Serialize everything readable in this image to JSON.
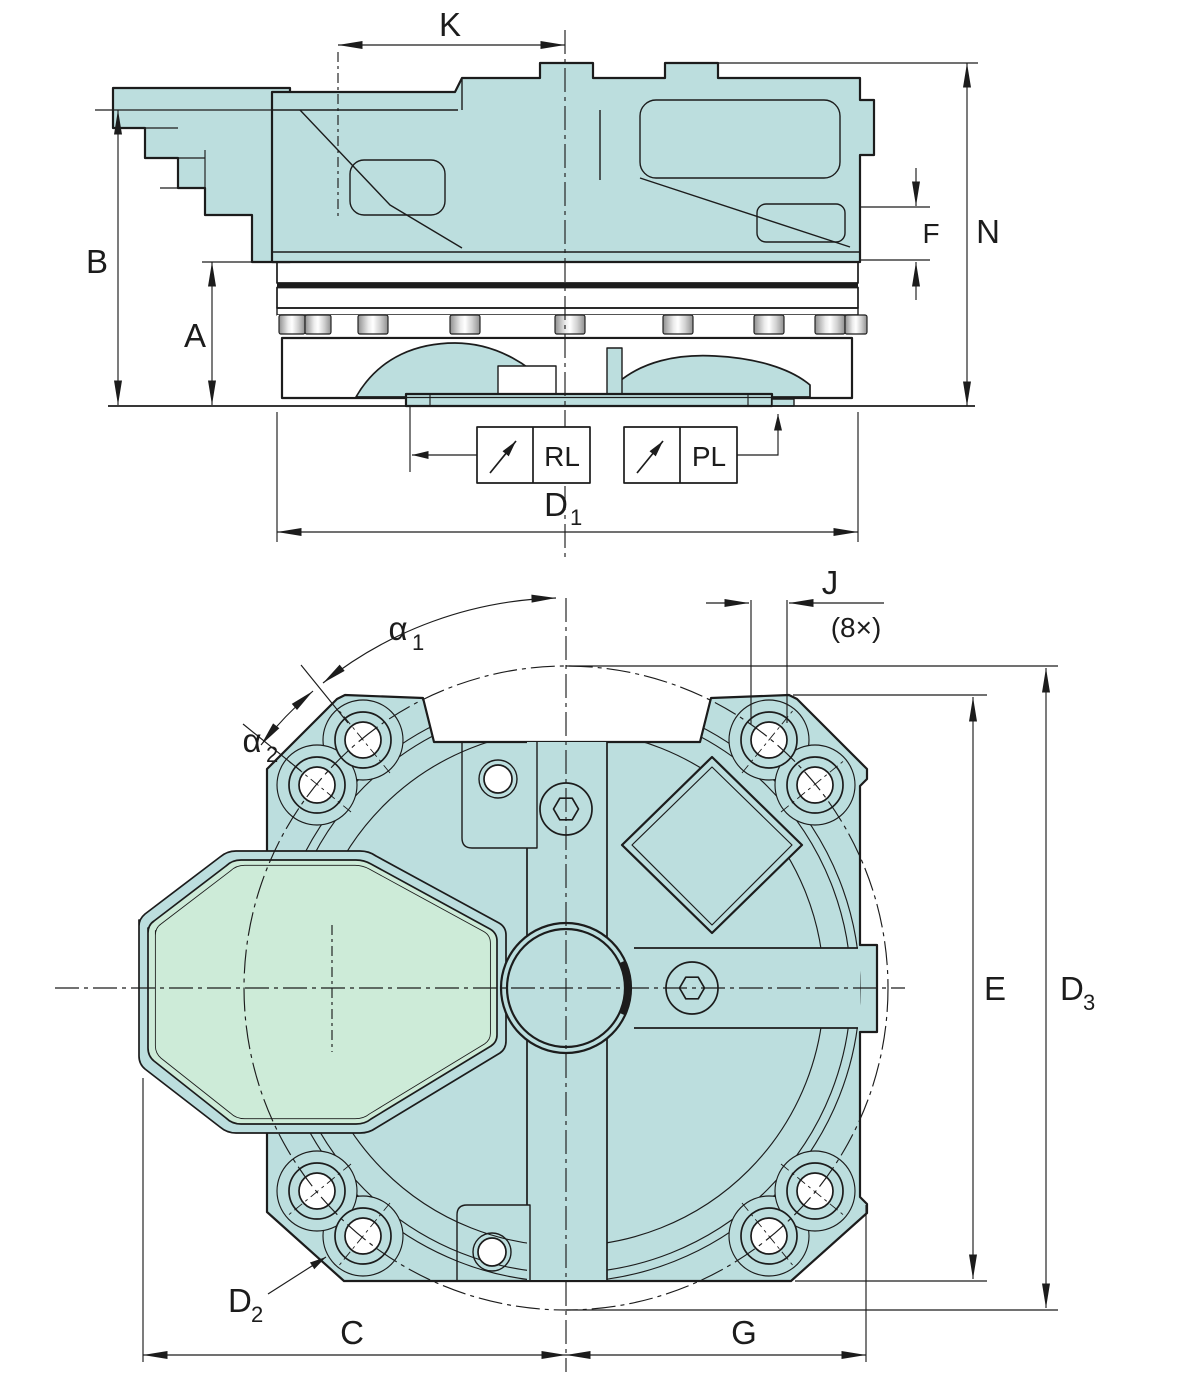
{
  "colors": {
    "body": "#bcdede",
    "cam": "#cdebd8",
    "line": "#1c1c1c",
    "band_light": "#f4fbfb"
  },
  "side_view": {
    "dim_K": "K",
    "dim_B": "B",
    "dim_A": "A",
    "dim_F": "F",
    "dim_N": "N",
    "dim_D1": {
      "main": "D",
      "sub": "1"
    },
    "port_RL": "RL",
    "port_PL": "PL"
  },
  "front_view": {
    "dim_alpha1": {
      "main": "α",
      "sub": "1"
    },
    "dim_alpha2": {
      "main": "α",
      "sub": "2"
    },
    "dim_J": "J",
    "dim_J_count": "(8×)",
    "dim_E": "E",
    "dim_D3": {
      "main": "D",
      "sub": "3"
    },
    "dim_D2": {
      "main": "D",
      "sub": "2"
    },
    "dim_C": "C",
    "dim_G": "G"
  }
}
